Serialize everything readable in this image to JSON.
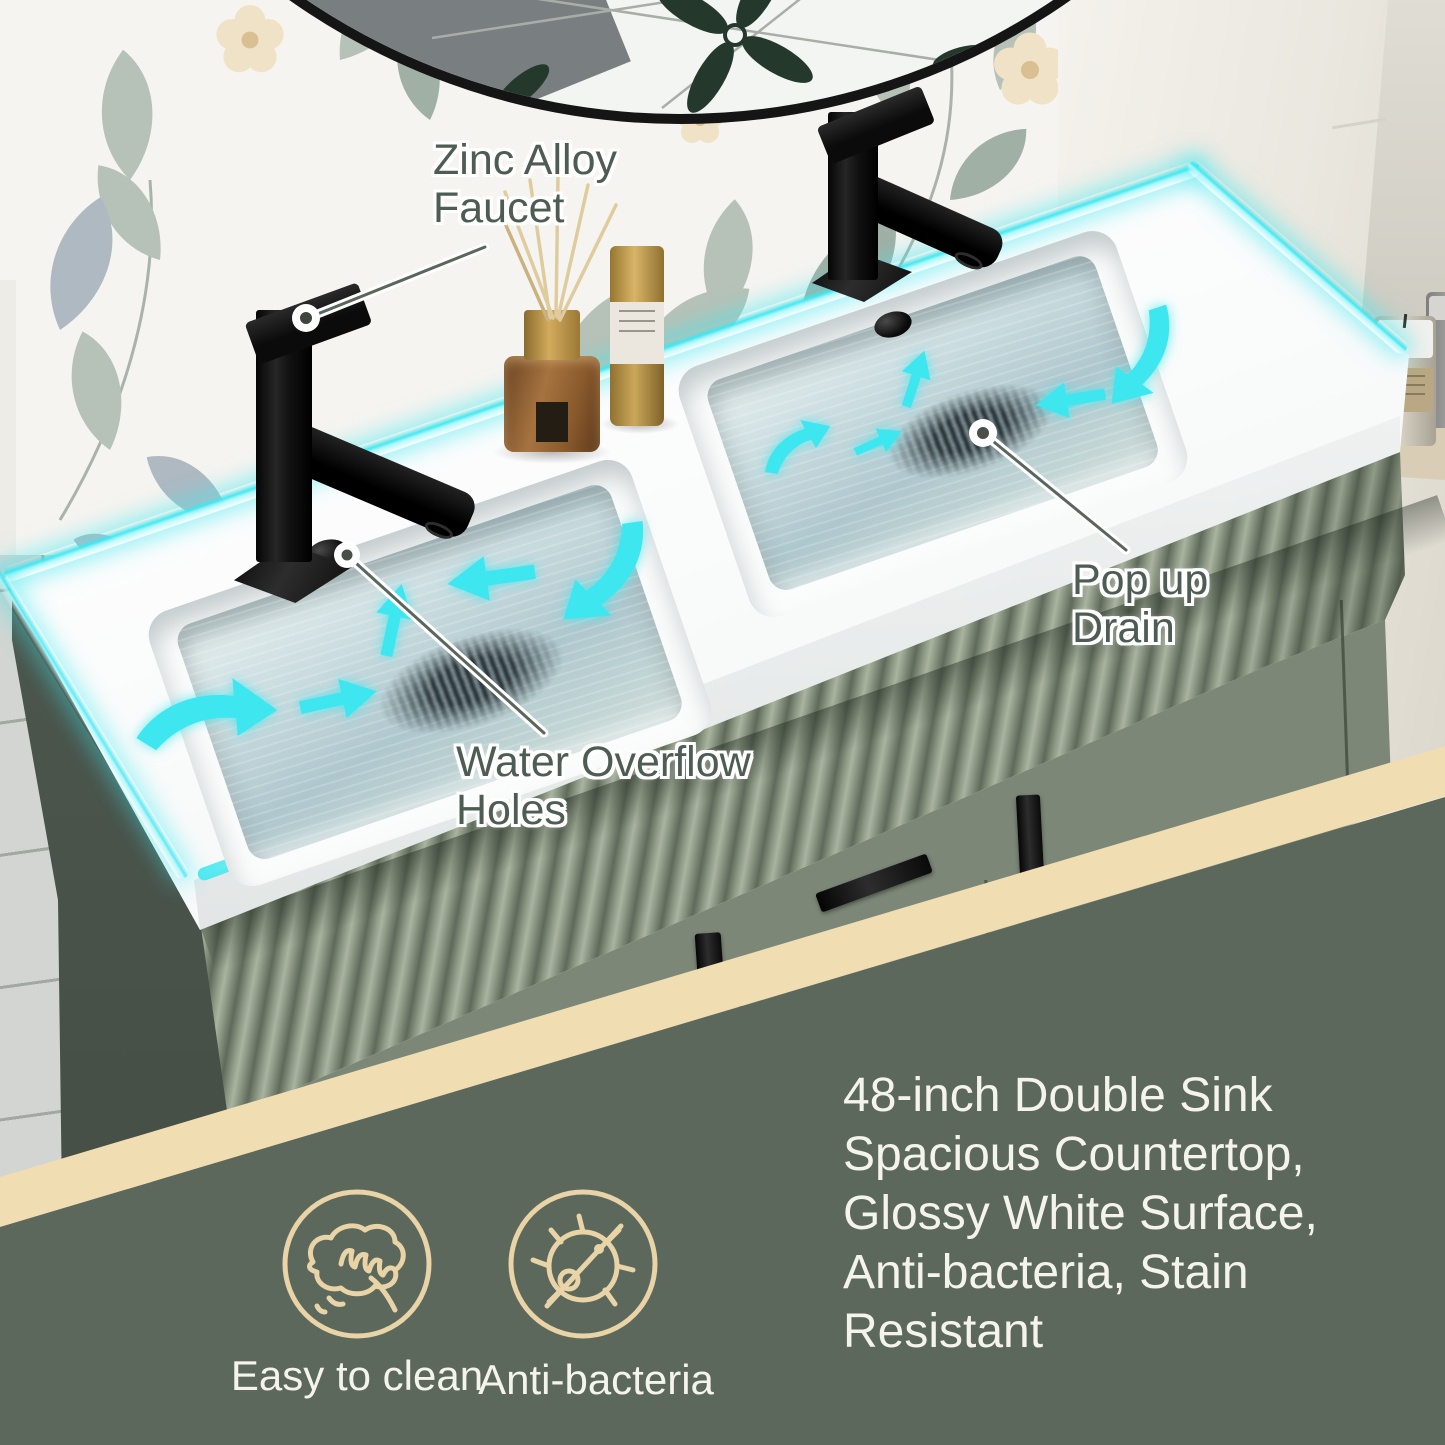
{
  "callouts": {
    "faucet": {
      "line1": "Zinc Alloy",
      "line2": "Faucet"
    },
    "drain": {
      "line1": "Pop up",
      "line2": "Drain"
    },
    "overflow": {
      "line1": "Water Overflow",
      "line2": "Holes"
    }
  },
  "features": {
    "items": [
      {
        "icon": "hand-wipe-icon",
        "label": "Easy to clean"
      },
      {
        "icon": "anti-bacteria-icon",
        "label": "Anti-bacteria"
      }
    ]
  },
  "description": {
    "text": "48-inch Double Sink Spacious Countertop, Glossy White Surface, Anti-bacteria, Stain Resistant",
    "lines": [
      "48-inch Double Sink",
      "Spacious Countertop,",
      "Glossy White Surface,",
      "Anti-bacteria, Stain",
      "Resistant"
    ]
  },
  "colors": {
    "accent_cyan": "#3EE7F0",
    "panel_green": "#5D685D",
    "stripe_cream": "#F0DEB2",
    "icon_cream": "#E8D4A6",
    "callout_text_green": "#4E5D53",
    "text_white": "#F4F4EC",
    "cabinet_green": "#8B9683",
    "cabinet_door_green": "#7C8777",
    "wall_shadow_green": "#4A544B",
    "countertop_white": "#FBFCFC",
    "water_blue": "#B7CED3",
    "faucet_black": "#141414",
    "wallpaper_cream": "#F5F3EF"
  }
}
